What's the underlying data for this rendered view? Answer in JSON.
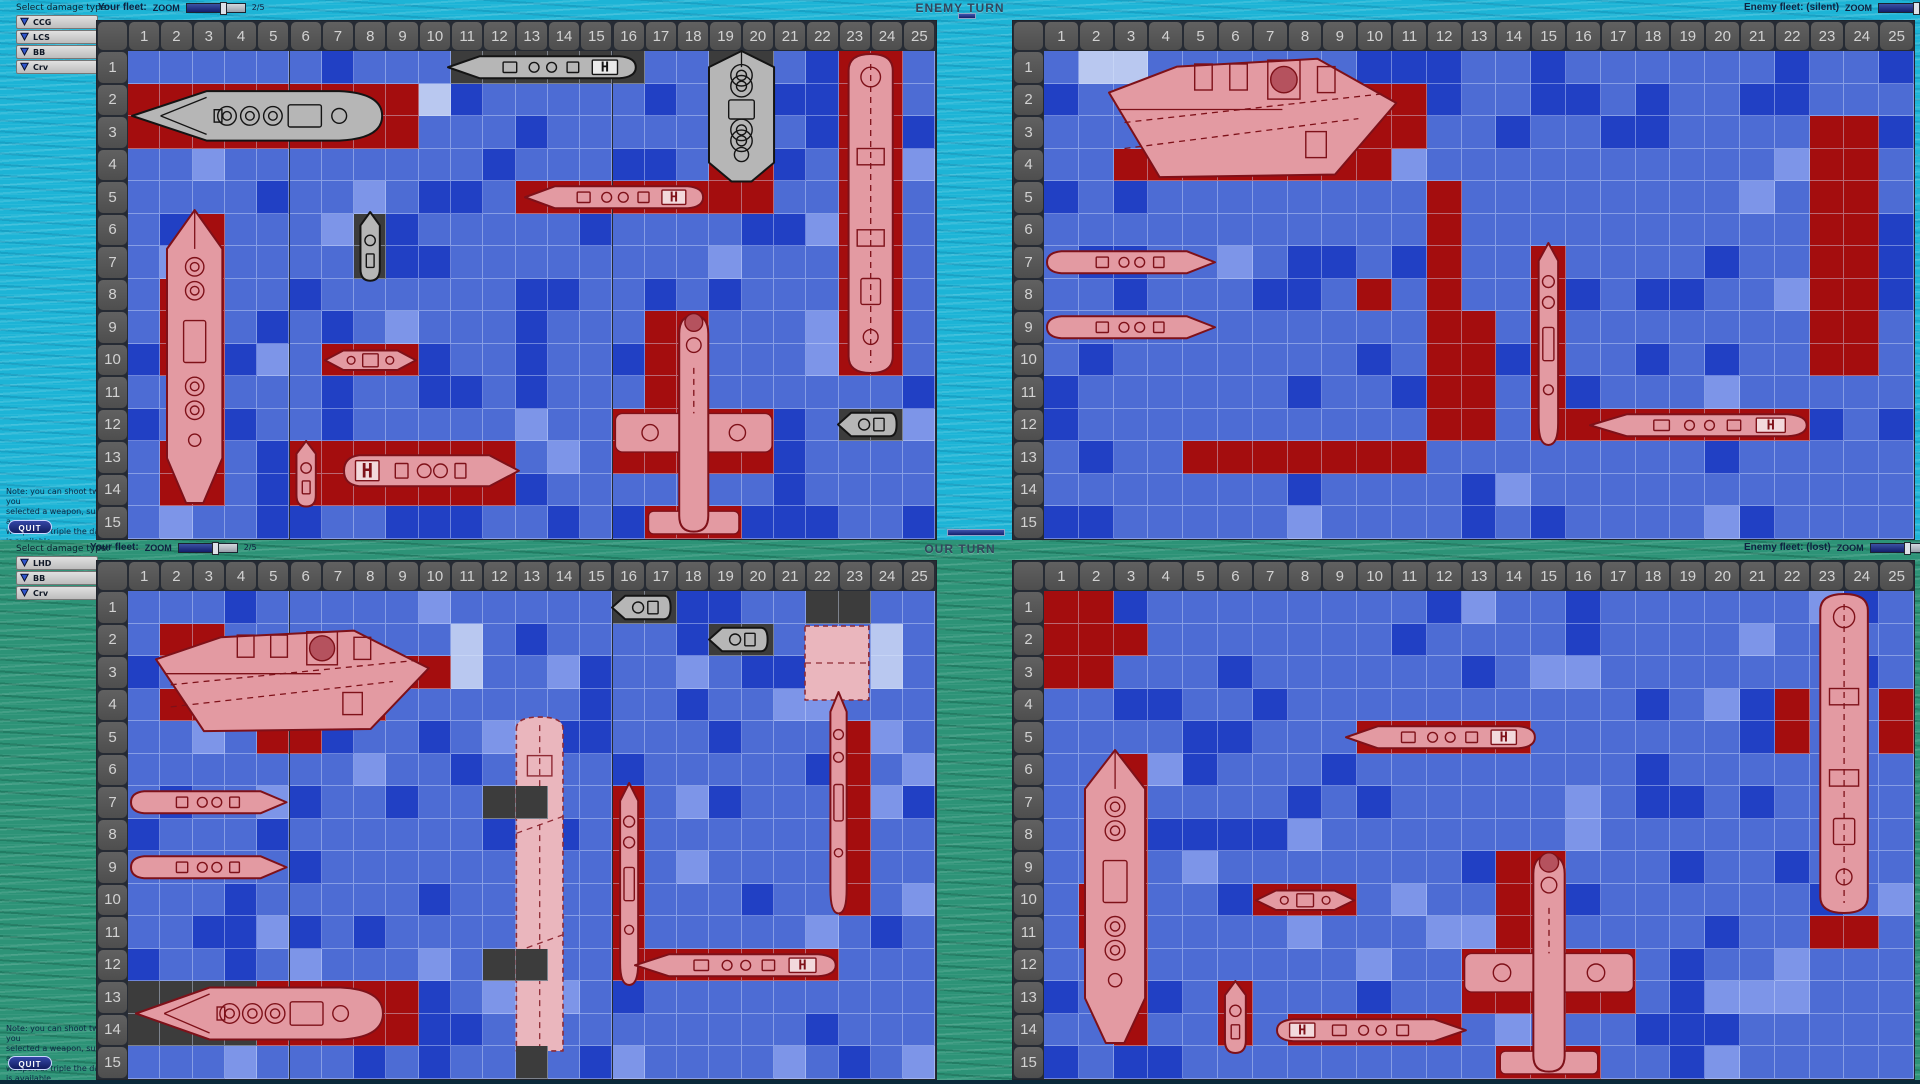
{
  "app": {
    "top_turn_label": "ENEMY TURN",
    "bottom_turn_label": "OUR TURN",
    "quit_label": "QUIT",
    "zoom_label": "ZOOM",
    "zoom_value": "2/5",
    "hpad_letter": "H"
  },
  "headers": {
    "tl": "Your fleet:",
    "tr": "Enemy fleet: (silent)",
    "bl": "Your fleet:",
    "br": "Enemy fleet: (lost)"
  },
  "legend_top": {
    "title": "Select damage type:",
    "items": [
      "CCG",
      "LCS",
      "BB",
      "Crv"
    ]
  },
  "legend_bottom": {
    "title": "Select damage type:",
    "items": [
      "LHD",
      "BB",
      "Crv"
    ]
  },
  "note_lines": [
    "Note: you can shoot twice, if you",
    "selected a weapon, such that a",
    "weapon of triple the damage is available..."
  ],
  "colors": {
    "water_base": "#4d6cd4",
    "water_dark": "#2140c4",
    "water_light": "#7d95e8",
    "cell_hit": "#a40d0e",
    "cell_dark": "#3c3c3c",
    "cell_pale": "#b9c8f0",
    "header_bg": "#575757",
    "sea_top": "#1db4d6",
    "sea_bottom": "#2d9377",
    "ship_intact": "#b6b6b6",
    "ship_damaged": "#e39aa2",
    "ship_outline": "#7e1119"
  },
  "boards": {
    "tl": {
      "name": "board-your-fleet-top",
      "left": 96,
      "top": 20,
      "cols": 25,
      "rows": 15,
      "cellW": 32.3,
      "cellH": 32.5,
      "headerW": 31,
      "headerH": 30,
      "seed": 11,
      "red": [
        [
          1,
          2,
          9,
          2
        ],
        [
          19,
          4,
          2,
          2
        ],
        [
          23,
          1,
          2,
          10
        ],
        [
          13,
          5,
          6,
          1
        ],
        [
          3,
          6,
          1,
          9
        ],
        [
          2,
          8,
          1,
          3
        ],
        [
          2,
          13,
          2,
          2
        ],
        [
          7,
          10,
          3,
          1
        ],
        [
          17,
          9,
          2,
          3
        ],
        [
          16,
          12,
          5,
          2
        ],
        [
          17,
          15,
          3,
          1
        ],
        [
          7,
          13,
          6,
          2
        ],
        [
          6,
          13,
          1,
          2
        ]
      ],
      "dark": [
        [
          11,
          1,
          6,
          1
        ],
        [
          19,
          1,
          2,
          3
        ],
        [
          8,
          6,
          1,
          2
        ],
        [
          23,
          12,
          2,
          1
        ]
      ],
      "pale": [
        [
          10,
          2,
          1,
          1
        ]
      ],
      "overlay": [],
      "ships": [
        {
          "type": "battleship-h",
          "x": 1.05,
          "y": 2.05,
          "w": 7.9,
          "h": 1.9,
          "variant": "intact"
        },
        {
          "type": "destroyer-h",
          "x": 10.8,
          "y": 1,
          "w": 6,
          "h": 1,
          "variant": "intact",
          "bow": "left",
          "hpad": "right"
        },
        {
          "type": "bb-v",
          "x": 18.9,
          "y": 0.9,
          "w": 2.2,
          "h": 4.2,
          "variant": "intact"
        },
        {
          "type": "carrier-v",
          "x": 23.05,
          "y": 1,
          "w": 1.9,
          "h": 10,
          "variant": "damaged"
        },
        {
          "type": "destroyer-h",
          "x": 13.2,
          "y": 5,
          "w": 5.7,
          "h": 1,
          "variant": "damaged",
          "bow": "left",
          "hpad": "right"
        },
        {
          "type": "smallboat-v",
          "x": 8,
          "y": 5.85,
          "w": 1,
          "h": 2.3,
          "variant": "intact"
        },
        {
          "type": "bb-v",
          "x": 2.1,
          "y": 5.8,
          "w": 1.9,
          "h": 9.2,
          "variant": "damaged"
        },
        {
          "type": "smallship-h",
          "x": 7,
          "y": 10,
          "w": 3,
          "h": 1,
          "variant": "damaged"
        },
        {
          "type": "plane-v",
          "x": 16,
          "y": 9,
          "w": 5,
          "h": 7,
          "variant": "damaged"
        },
        {
          "type": "smallboat-h",
          "x": 22.9,
          "y": 11.9,
          "w": 2,
          "h": 1.2,
          "variant": "intact"
        },
        {
          "type": "destroyer-h",
          "x": 7.6,
          "y": 13.2,
          "w": 5.6,
          "h": 1.4,
          "variant": "damaged",
          "bow": "right",
          "hpad": "left"
        },
        {
          "type": "smallboat-v",
          "x": 6,
          "y": 12.9,
          "w": 1,
          "h": 2.2,
          "variant": "damaged"
        }
      ]
    },
    "tr": {
      "name": "board-enemy-fleet-top",
      "left": 1012,
      "top": 20,
      "cols": 25,
      "rows": 15,
      "cellW": 34.8,
      "cellH": 32.5,
      "headerW": 31,
      "headerH": 30,
      "seed": 22,
      "red": [
        [
          9,
          2,
          3,
          2
        ],
        [
          3,
          4,
          8,
          1
        ],
        [
          12,
          5,
          1,
          4
        ],
        [
          12,
          9,
          2,
          4
        ],
        [
          5,
          13,
          7,
          1
        ],
        [
          15,
          7,
          1,
          6
        ],
        [
          16,
          12,
          7,
          1
        ],
        [
          23,
          3,
          2,
          8
        ],
        [
          10,
          8,
          1,
          1
        ]
      ],
      "dark": [],
      "pale": [
        [
          2,
          1,
          2,
          1
        ]
      ],
      "overlay": [],
      "ships": [
        {
          "type": "carrier-h",
          "x": 2.8,
          "y": 1,
          "w": 8.4,
          "h": 4,
          "variant": "damaged"
        },
        {
          "type": "destroyer-h",
          "x": 1,
          "y": 7,
          "w": 5,
          "h": 1,
          "variant": "damaged",
          "bow": "right"
        },
        {
          "type": "destroyer-h",
          "x": 1,
          "y": 9,
          "w": 5,
          "h": 1,
          "variant": "damaged",
          "bow": "right"
        },
        {
          "type": "cruiser-v",
          "x": 15,
          "y": 6.8,
          "w": 1,
          "h": 6.4,
          "variant": "damaged"
        },
        {
          "type": "destroyer-h",
          "x": 16.6,
          "y": 12,
          "w": 6.4,
          "h": 1,
          "variant": "damaged",
          "bow": "left",
          "hpad": "right"
        }
      ]
    },
    "bl": {
      "name": "board-your-fleet-bottom",
      "left": 96,
      "top": 560,
      "cols": 25,
      "rows": 15,
      "cellW": 32.3,
      "cellH": 32.5,
      "headerW": 31,
      "headerH": 30,
      "seed": 33,
      "red": [
        [
          2,
          2,
          2,
          1
        ],
        [
          2,
          4,
          3,
          1
        ],
        [
          6,
          4,
          3,
          1
        ],
        [
          9,
          3,
          2,
          1
        ],
        [
          5,
          5,
          2,
          1
        ],
        [
          16,
          7,
          1,
          6
        ],
        [
          17,
          12,
          6,
          1
        ],
        [
          5,
          13,
          5,
          2
        ],
        [
          23,
          5,
          1,
          6
        ]
      ],
      "dark": [
        [
          16,
          1,
          2,
          1
        ],
        [
          19,
          2,
          2,
          1
        ],
        [
          22,
          1,
          2,
          1
        ],
        [
          12,
          7,
          1,
          1
        ],
        [
          12,
          12,
          1,
          1
        ],
        [
          1,
          13,
          4,
          2
        ]
      ],
      "pale": [
        [
          11,
          2,
          1,
          2
        ],
        [
          24,
          2,
          1,
          2
        ]
      ],
      "overlay": [
        [
          13,
          7,
          1,
          1
        ],
        [
          13,
          12,
          1,
          1
        ],
        [
          13,
          15,
          1,
          1
        ]
      ],
      "ships": [
        {
          "type": "carrier-h",
          "x": 1.8,
          "y": 2,
          "w": 8.6,
          "h": 3.4,
          "variant": "damaged"
        },
        {
          "type": "smallboat-h",
          "x": 15.9,
          "y": 0.9,
          "w": 2,
          "h": 1.2,
          "variant": "intact"
        },
        {
          "type": "smallboat-h",
          "x": 18.9,
          "y": 1.9,
          "w": 2,
          "h": 1.2,
          "variant": "intact"
        },
        {
          "type": "deck-rect",
          "x": 21.9,
          "y": 2,
          "w": 2.1,
          "h": 2.4,
          "variant": "pale"
        },
        {
          "type": "destroyer-h",
          "x": 1,
          "y": 7,
          "w": 5,
          "h": 1,
          "variant": "damaged",
          "bow": "right"
        },
        {
          "type": "destroyer-h",
          "x": 1,
          "y": 9,
          "w": 5,
          "h": 1,
          "variant": "damaged",
          "bow": "right"
        },
        {
          "type": "deck-v",
          "x": 12.8,
          "y": 4.8,
          "w": 1.9,
          "h": 10.4,
          "variant": "pale"
        },
        {
          "type": "cruiser-v",
          "x": 16,
          "y": 6.8,
          "w": 1,
          "h": 6.4,
          "variant": "damaged"
        },
        {
          "type": "battleship-h",
          "x": 1.2,
          "y": 13,
          "w": 7.8,
          "h": 2,
          "variant": "damaged"
        },
        {
          "type": "destroyer-h",
          "x": 16.6,
          "y": 12,
          "w": 6.4,
          "h": 1,
          "variant": "damaged",
          "bow": "left",
          "hpad": "right"
        },
        {
          "type": "cruiser-v",
          "x": 22.55,
          "y": 4,
          "w": 0.9,
          "h": 7,
          "variant": "damaged"
        }
      ]
    },
    "br": {
      "name": "board-enemy-fleet-bottom",
      "left": 1012,
      "top": 560,
      "cols": 25,
      "rows": 15,
      "cellW": 34.8,
      "cellH": 32.5,
      "headerW": 31,
      "headerH": 30,
      "seed": 44,
      "red": [
        [
          1,
          1,
          2,
          1
        ],
        [
          1,
          2,
          3,
          1
        ],
        [
          1,
          3,
          2,
          1
        ],
        [
          10,
          5,
          5,
          1
        ],
        [
          3,
          6,
          1,
          9
        ],
        [
          2,
          10,
          1,
          2
        ],
        [
          3,
          13,
          1,
          2
        ],
        [
          7,
          10,
          3,
          1
        ],
        [
          14,
          9,
          2,
          3
        ],
        [
          13,
          12,
          5,
          2
        ],
        [
          14,
          15,
          3,
          1
        ],
        [
          8,
          14,
          5,
          1
        ],
        [
          6,
          13,
          1,
          2
        ],
        [
          22,
          4,
          1,
          2
        ],
        [
          25,
          4,
          1,
          2
        ],
        [
          23,
          11,
          2,
          1
        ]
      ],
      "dark": [],
      "pale": [],
      "overlay": [],
      "ships": [
        {
          "type": "destroyer-h",
          "x": 9.6,
          "y": 5,
          "w": 5.6,
          "h": 1,
          "variant": "damaged",
          "bow": "left",
          "hpad": "right"
        },
        {
          "type": "bb-v",
          "x": 2.1,
          "y": 5.8,
          "w": 1.9,
          "h": 9.2,
          "variant": "damaged"
        },
        {
          "type": "smallship-h",
          "x": 7,
          "y": 10,
          "w": 3,
          "h": 1,
          "variant": "damaged"
        },
        {
          "type": "plane-v",
          "x": 13,
          "y": 9,
          "w": 5,
          "h": 7,
          "variant": "damaged"
        },
        {
          "type": "destroyer-h",
          "x": 7.6,
          "y": 14,
          "w": 5.6,
          "h": 1,
          "variant": "damaged",
          "bow": "right",
          "hpad": "left"
        },
        {
          "type": "smallboat-v",
          "x": 6,
          "y": 12.9,
          "w": 1,
          "h": 2.4,
          "variant": "damaged"
        },
        {
          "type": "carrier-v",
          "x": 23.05,
          "y": 1,
          "w": 1.9,
          "h": 10,
          "variant": "damaged"
        }
      ]
    }
  }
}
